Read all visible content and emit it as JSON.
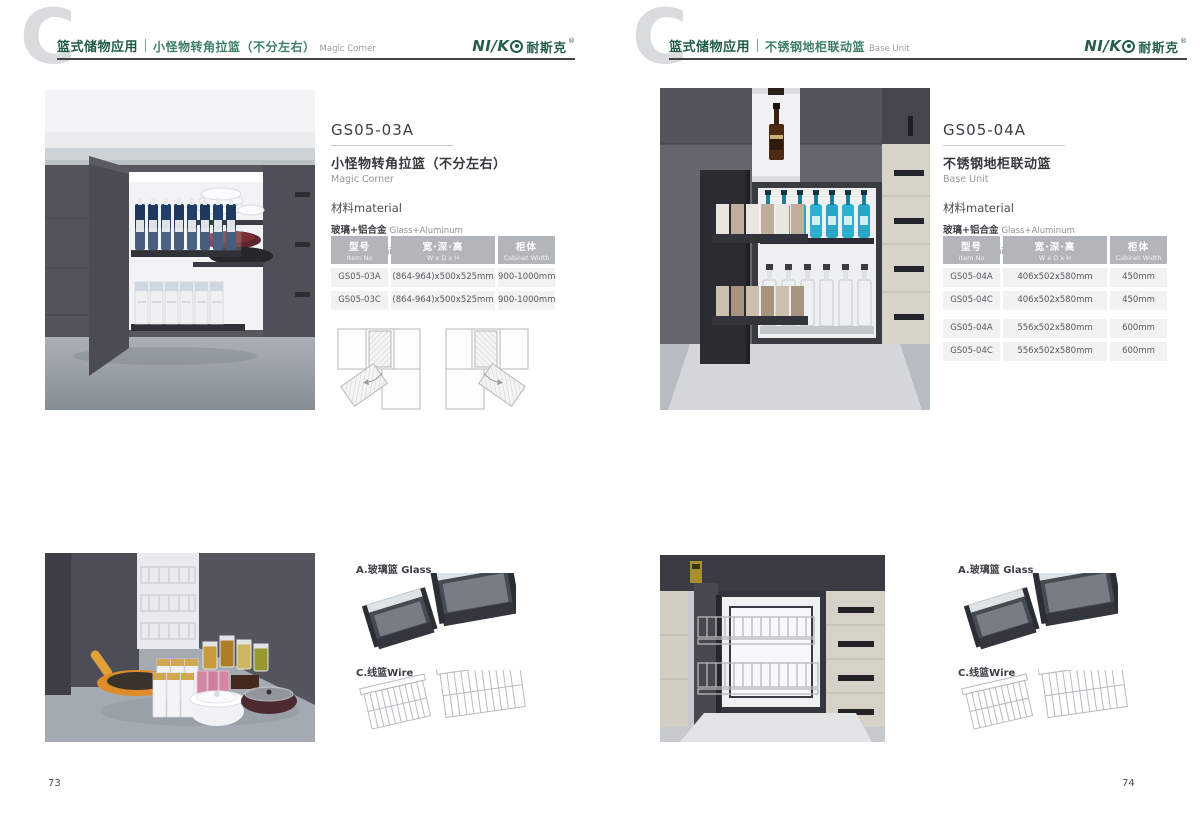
{
  "brand": {
    "logo_latin": "NI/K",
    "logo_cn": "耐斯克",
    "registered": "®",
    "green": "#265f45"
  },
  "pages": [
    {
      "page_number": "73",
      "watermark": "C",
      "header": {
        "category": "篮式储物应用",
        "product_cn": "小怪物转角拉篮（不分左右）",
        "product_en": "Magic Corner"
      },
      "product": {
        "model": "GS05-03A",
        "name_cn": "小怪物转角拉篮（不分左右）",
        "name_en": "Magic Corner",
        "material_heading": "材料material",
        "materials": [
          {
            "cn": "玻璃+铝合金",
            "en": "Glass+Aluminum"
          },
          {
            "cn": "不锈钢/铁",
            "en": "Stainless SteeL/Iron"
          }
        ]
      },
      "spec_table": {
        "headers": [
          {
            "cn": "型号",
            "en": "Item No"
          },
          {
            "cn": "宽·深·高",
            "en": "W x D x H"
          },
          {
            "cn": "柜体",
            "en": "Cabinet Width"
          }
        ],
        "rows": [
          [
            "GS05-03A",
            "(864-964)x500x525mm",
            "900-1000mm"
          ],
          [
            "GS05-03C",
            "(864-964)x500x525mm",
            "900-1000mm"
          ]
        ]
      },
      "accessories": [
        {
          "label": "A.玻璃篮 Glass"
        },
        {
          "label": "C.线篮Wire"
        }
      ]
    },
    {
      "page_number": "74",
      "watermark": "C",
      "header": {
        "category": "篮式储物应用",
        "product_cn": "不锈钢地柜联动篮",
        "product_en": "Base Unit"
      },
      "product": {
        "model": "GS05-04A",
        "name_cn": "不锈钢地柜联动篮",
        "name_en": "Base Unit",
        "material_heading": "材料material",
        "materials": [
          {
            "cn": "玻璃+铝合金",
            "en": "Glass+Aluminum"
          },
          {
            "cn": "不锈钢/铁",
            "en": "Stainless SteeL/Iron"
          }
        ]
      },
      "spec_table": {
        "headers": [
          {
            "cn": "型号",
            "en": "Item No"
          },
          {
            "cn": "宽·深·高",
            "en": "W x D x H"
          },
          {
            "cn": "柜体",
            "en": "Cabinet Width"
          }
        ],
        "rows": [
          [
            "GS05-04A",
            "406x502x580mm",
            "450mm"
          ],
          [
            "GS05-04C",
            "406x502x580mm",
            "450mm"
          ],
          [
            "GS05-04A",
            "556x502x580mm",
            "600mm"
          ],
          [
            "GS05-04C",
            "556x502x580mm",
            "600mm"
          ]
        ]
      },
      "accessories": [
        {
          "label": "A.玻璃篮 Glass"
        },
        {
          "label": "C.线篮Wire"
        }
      ]
    }
  ]
}
